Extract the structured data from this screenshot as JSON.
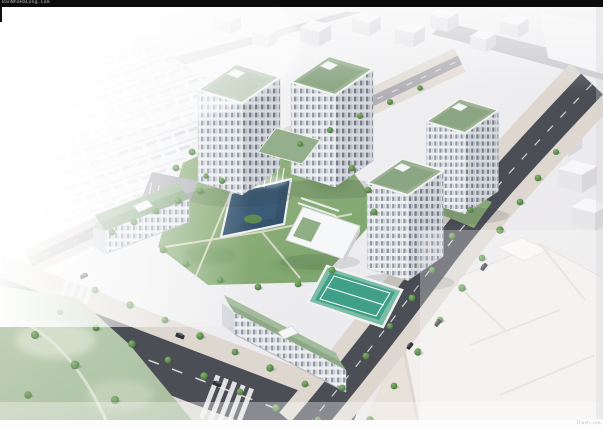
{
  "watermarks": {
    "top_left": "BanNhaHaLong.Com",
    "bottom_right": "Thanh.com"
  },
  "palette": {
    "top_bar_black": "#0b0b0b",
    "roof_green": "#9cb292",
    "lawn_green": "#85a873",
    "pool_blue": "#3c5e7b",
    "court_green": "#3f9f88",
    "road_dark": "#4b4e55",
    "sidewalk_beige": "#ddd7d0",
    "facade_white": "#eef0f2",
    "background_white": "#f4f3f4"
  }
}
